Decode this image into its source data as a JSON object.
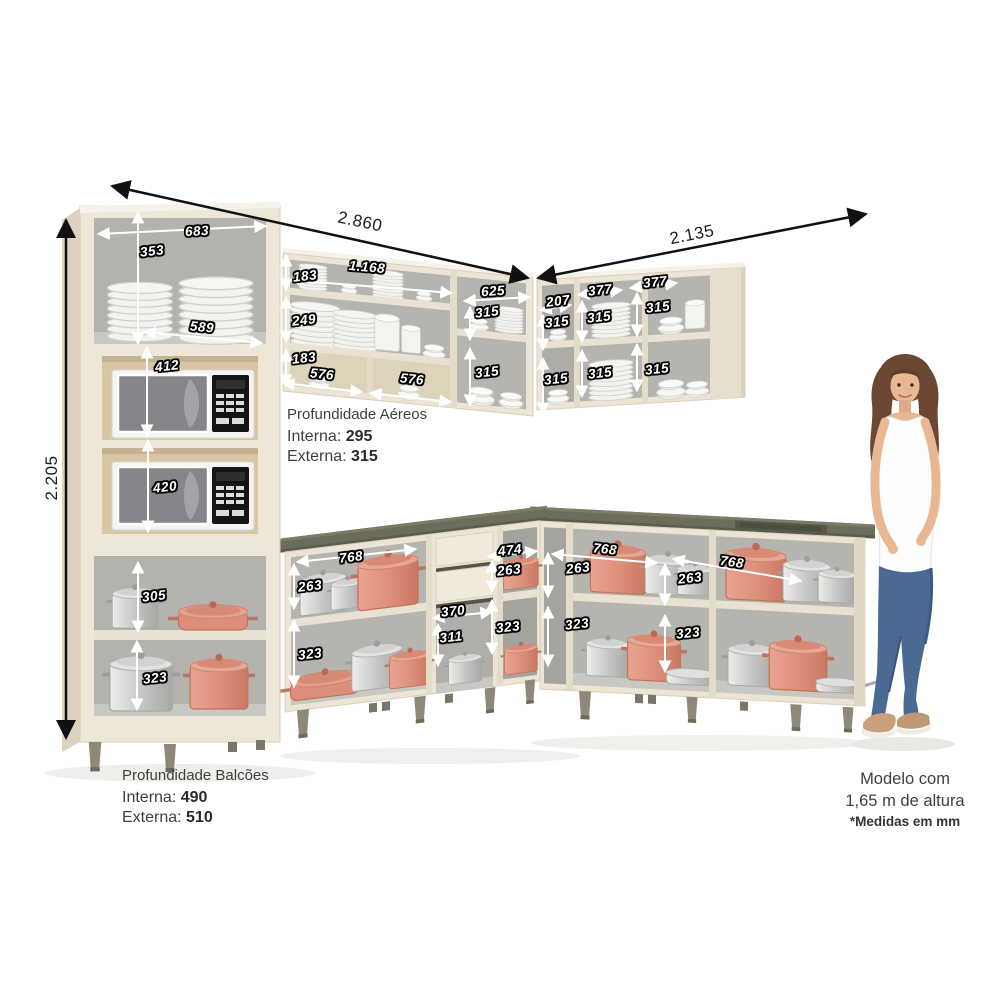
{
  "big_dims": {
    "left_run_width": "2.860",
    "right_run_width": "2.135",
    "total_height": "2.205"
  },
  "dims": {
    "d683": "683",
    "d353": "353",
    "d589": "589",
    "d412": "412",
    "d420": "420",
    "d305": "305",
    "d323a": "323",
    "d1168": "1.168",
    "d183a": "183",
    "d249": "249",
    "d183b": "183",
    "d576a": "576",
    "d576b": "576",
    "d625": "625",
    "d315a": "315",
    "d315b": "315",
    "d207": "207",
    "d315c": "315",
    "d315d": "315",
    "d377a": "377",
    "d315e": "315",
    "d315f": "315",
    "d377b": "377",
    "d315g": "315",
    "d315h": "315",
    "d768a": "768",
    "d263a": "263",
    "d323b": "323",
    "d370": "370",
    "d311": "311",
    "d474": "474",
    "d263b": "263",
    "d323c": "323",
    "d768b": "768",
    "d263c": "263",
    "d323d": "323",
    "d768c": "768",
    "d263d": "263",
    "d323e": "323"
  },
  "notes": {
    "aereos": {
      "title": "Profundidade Aéreos",
      "interna_label": "Interna:",
      "interna_value": "295",
      "externa_label": "Externa:",
      "externa_value": "315"
    },
    "balcoes": {
      "title": "Profundidade Balcões",
      "interna_label": "Interna:",
      "interna_value": "490",
      "externa_label": "Externa:",
      "externa_value": "510"
    },
    "modelo": {
      "line1": "Modelo com",
      "line2": "1,65 m de altura",
      "line3": "*Medidas em mm"
    }
  },
  "colors": {
    "cabinet_body": "#ece4d4",
    "cabinet_interior": "#b6b4af",
    "niche_interior": "#d7c5a5",
    "countertop": "#6c6c5a",
    "pot_salmon": "#dd8e7a",
    "pot_steel": "#c6c6c4",
    "arrow_white": "#ffffff",
    "arrow_black": "#111111",
    "text_dark": "#3f3f3f"
  }
}
